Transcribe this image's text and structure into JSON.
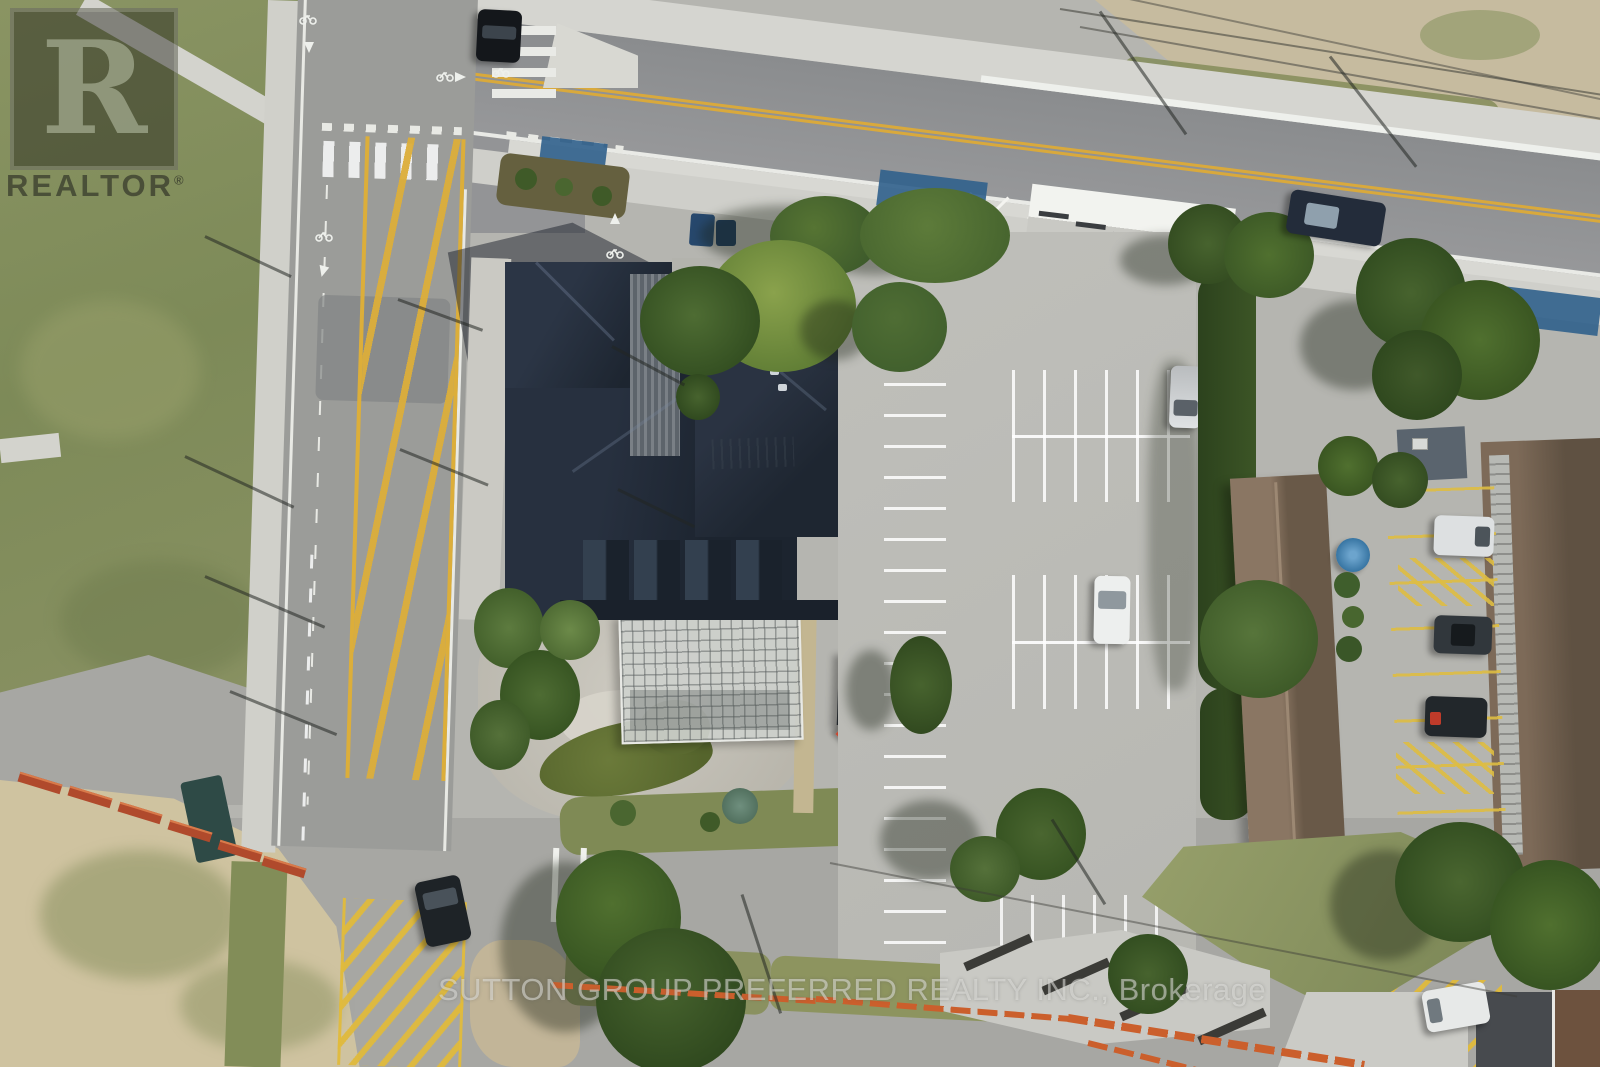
{
  "meta": {
    "title": "Aerial drone photograph of a commercial property listing",
    "view": "top-down"
  },
  "watermarks": {
    "logo_letter": "R",
    "logo_label": "REALTOR",
    "registered_mark": "®",
    "brokerage_text": "SUTTON GROUP PREFERRED REALTY INC., Brokerage"
  },
  "scene": {
    "description": "Top-down aerial view: dark-roofed commercial building with greenhouse and pond garden, large concrete parking lot with white stalls, main road with double yellow line and blue bike lanes at top, side street with yellow hatched ladder marking at left, grass field and sandy lot, brown-roofed neighbouring buildings with yellow-lined parking at right, orange construction fencing along the bottom roads.",
    "markings": [
      "double-yellow-centre-line",
      "yellow-hatched-ladder",
      "zebra-crosswalk",
      "bicycle-stencil",
      "straight-arrow",
      "white-parking-stalls",
      "yellow-parking-stalls",
      "yellow-no-parking-hatch",
      "blue-bike-lane-paint"
    ],
    "vehicles": [
      {
        "name": "black-car-top-intersection",
        "color": "#14171b"
      },
      {
        "name": "dark-car-main-road",
        "color": "#232c3a"
      },
      {
        "name": "silver-car-parking-lot",
        "color": "#c9cdd0"
      },
      {
        "name": "white-car-parking-lot",
        "color": "#edefee"
      },
      {
        "name": "white-van-right-lane",
        "color": "#dde0e1"
      },
      {
        "name": "dark-car-right-lane",
        "color": "#31373c"
      },
      {
        "name": "black-car-right-lane",
        "color": "#22272b"
      },
      {
        "name": "dark-car-bottom-road",
        "color": "#1e2327"
      },
      {
        "name": "white-van-bottom-right",
        "color": "#e7e9e8"
      }
    ],
    "features": [
      {
        "name": "main-building",
        "roof_color": "#222a36"
      },
      {
        "name": "greenhouse",
        "color": "#cdd0cc"
      },
      {
        "name": "pond",
        "color": "#5f6d34"
      },
      {
        "name": "gazebo",
        "color": "#23282c"
      },
      {
        "name": "red-umbrella",
        "color": "#d7513a"
      },
      {
        "name": "blue-umbrella",
        "color": "#3f7fb5"
      },
      {
        "name": "brown-building-west",
        "roof_color": "#7b6756"
      },
      {
        "name": "brown-building-east",
        "roof_color": "#6e5c4a"
      },
      {
        "name": "grass-field",
        "color": "#86905e"
      },
      {
        "name": "sand-lot",
        "color": "#cfc3a0"
      },
      {
        "name": "construction-fence",
        "color": "#cb5f2c"
      }
    ],
    "colors": {
      "asphalt_main": "#8e9092",
      "asphalt_side": "#9b9c99",
      "parking_concrete": "#bcbcb7",
      "sidewalk": "#d4d4cf",
      "marking_yellow": "#dcae3a",
      "marking_white": "#eef0ec",
      "bike_lane_blue": "#30618c",
      "grass": "#86905e",
      "tree_green": "#4c6c30",
      "sand": "#cfc3a0",
      "gravel": "#c6bb9f",
      "roof_dark": "#222a36",
      "roof_brown": "#7b6756",
      "watermark_light": "rgba(228,228,224,0.55)"
    }
  }
}
